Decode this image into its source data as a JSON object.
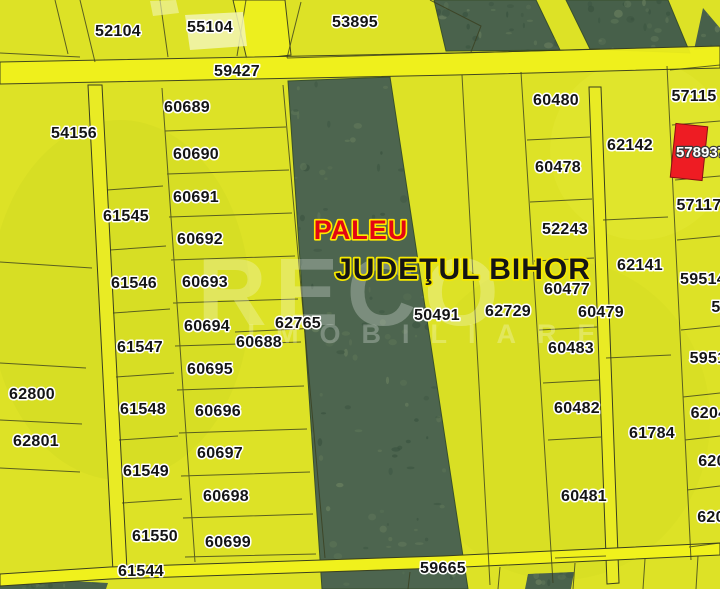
{
  "map": {
    "locality": "PALEU",
    "county": "JUDEŢUL BIHOR",
    "watermark": {
      "line1": "RECO",
      "line2": "IMOBILIARE"
    },
    "highlight": {
      "id": "578937",
      "color": "#ee1c23"
    },
    "colors": {
      "parcel_yellow": "#dde226",
      "road_yellow": "#f0f11c",
      "vegetation_green": "#4a624c",
      "boundary_line": "#3a3f1e",
      "label_halo": "#ffffff",
      "locality_red": "#e30613",
      "halo_yellow": "#f6e800",
      "highlight_red": "#ee1c23"
    },
    "parcels": [
      {
        "id": "52104",
        "x": 118,
        "y": 30
      },
      {
        "id": "55104",
        "x": 210,
        "y": 26
      },
      {
        "id": "53895",
        "x": 355,
        "y": 21
      },
      {
        "id": "59427",
        "x": 237,
        "y": 70
      },
      {
        "id": "60689",
        "x": 187,
        "y": 106
      },
      {
        "id": "54156",
        "x": 74,
        "y": 132
      },
      {
        "id": "60480",
        "x": 556,
        "y": 99
      },
      {
        "id": "57115",
        "x": 694,
        "y": 95
      },
      {
        "id": "62142",
        "x": 630,
        "y": 144
      },
      {
        "id": "60690",
        "x": 196,
        "y": 153
      },
      {
        "id": "60478",
        "x": 558,
        "y": 166
      },
      {
        "id": "60691",
        "x": 196,
        "y": 196
      },
      {
        "id": "57117",
        "x": 699,
        "y": 204
      },
      {
        "id": "61545",
        "x": 126,
        "y": 215
      },
      {
        "id": "52243",
        "x": 565,
        "y": 228
      },
      {
        "id": "60692",
        "x": 200,
        "y": 238
      },
      {
        "id": "62141",
        "x": 640,
        "y": 264
      },
      {
        "id": "61546",
        "x": 134,
        "y": 282
      },
      {
        "id": "60693",
        "x": 205,
        "y": 281
      },
      {
        "id": "60477",
        "x": 567,
        "y": 288
      },
      {
        "id": "59514",
        "x": 703,
        "y": 278
      },
      {
        "id": "5",
        "x": 716,
        "y": 306
      },
      {
        "id": "62729",
        "x": 508,
        "y": 310
      },
      {
        "id": "50491",
        "x": 437,
        "y": 314
      },
      {
        "id": "60479",
        "x": 601,
        "y": 311
      },
      {
        "id": "62765",
        "x": 298,
        "y": 322
      },
      {
        "id": "60694",
        "x": 207,
        "y": 325
      },
      {
        "id": "60688",
        "x": 259,
        "y": 341
      },
      {
        "id": "61547",
        "x": 140,
        "y": 346
      },
      {
        "id": "60483",
        "x": 571,
        "y": 347
      },
      {
        "id": "5951",
        "x": 708,
        "y": 357
      },
      {
        "id": "60695",
        "x": 210,
        "y": 368
      },
      {
        "id": "62800",
        "x": 32,
        "y": 393
      },
      {
        "id": "61548",
        "x": 143,
        "y": 408
      },
      {
        "id": "60696",
        "x": 218,
        "y": 410
      },
      {
        "id": "6204",
        "x": 709,
        "y": 412
      },
      {
        "id": "60482",
        "x": 577,
        "y": 407
      },
      {
        "id": "62801",
        "x": 36,
        "y": 440
      },
      {
        "id": "61784",
        "x": 652,
        "y": 432
      },
      {
        "id": "60697",
        "x": 220,
        "y": 452
      },
      {
        "id": "620",
        "x": 712,
        "y": 460
      },
      {
        "id": "61549",
        "x": 146,
        "y": 470
      },
      {
        "id": "60698",
        "x": 226,
        "y": 495
      },
      {
        "id": "60481",
        "x": 584,
        "y": 495
      },
      {
        "id": "620 ",
        "x": 711,
        "y": 516
      },
      {
        "id": "61550",
        "x": 155,
        "y": 535
      },
      {
        "id": "60699",
        "x": 228,
        "y": 541
      },
      {
        "id": "61544",
        "x": 141,
        "y": 570
      },
      {
        "id": "59665",
        "x": 443,
        "y": 567
      }
    ]
  }
}
